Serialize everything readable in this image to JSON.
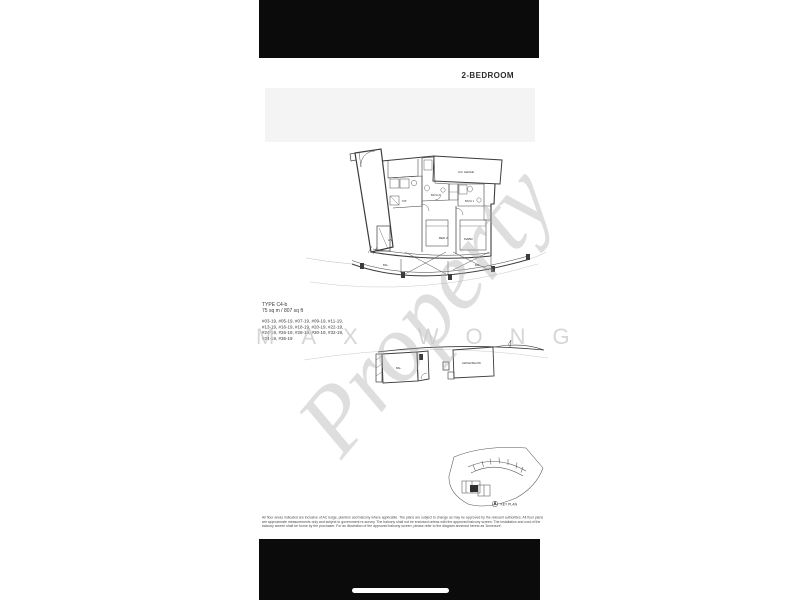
{
  "colors": {
    "letterbox_bar": "#0b0b0b",
    "page_background": "#ffffff",
    "header_band": "#f4f4f5",
    "plan_line": "#3c3c3c",
    "watermark_gray": "#c9c9c9"
  },
  "header": {
    "title": "2-BEDROOM"
  },
  "unit_info": {
    "type_label": "TYPE C4-b",
    "area": "75 sq m / 807 sq ft",
    "stacks": [
      "#03-19, #05-19, #07-19, #09-19, #11-19,",
      "#13-19, #16-19, #18-19, #20-19, #22-19,",
      "#24-19, #26-19, #28-19, #30-19, #32-19,",
      "#34-19, #36-19"
    ]
  },
  "floor_plan": {
    "labels": {
      "ac_ledge": "A/C LEDGE",
      "kitchen": "KIT.",
      "bath2": "BATH 2",
      "bath1": "BATH 1",
      "bed2": "BED 2",
      "master": "MABR",
      "living": "LIV",
      "bal_left": "BAL.",
      "bal_right": "BAL.",
      "lower_bal": "BAL.",
      "ledge_below": "LEDGE BELOW"
    }
  },
  "key_plan": {
    "label": "KEY PLAN"
  },
  "disclaimer": {
    "line1": "All floor areas indicated are inclusive of AC ledge, planters and balcony where applicable. The plans are subject to change as may be approved by the relevant authorities. All floor plans",
    "line2": "are approximate measurements only and subject to government re-survey. The balcony shall not be enclosed unless with the approved balcony screen. The installation and cost of the",
    "line3": "balcony screen shall be borne by the purchaser. For an illustration of the approved balcony screen, please refer to the diagram annexed hereto as 'Annexure'."
  },
  "watermark": {
    "diagonal": "Property",
    "horizontal": "MAX WONG"
  }
}
